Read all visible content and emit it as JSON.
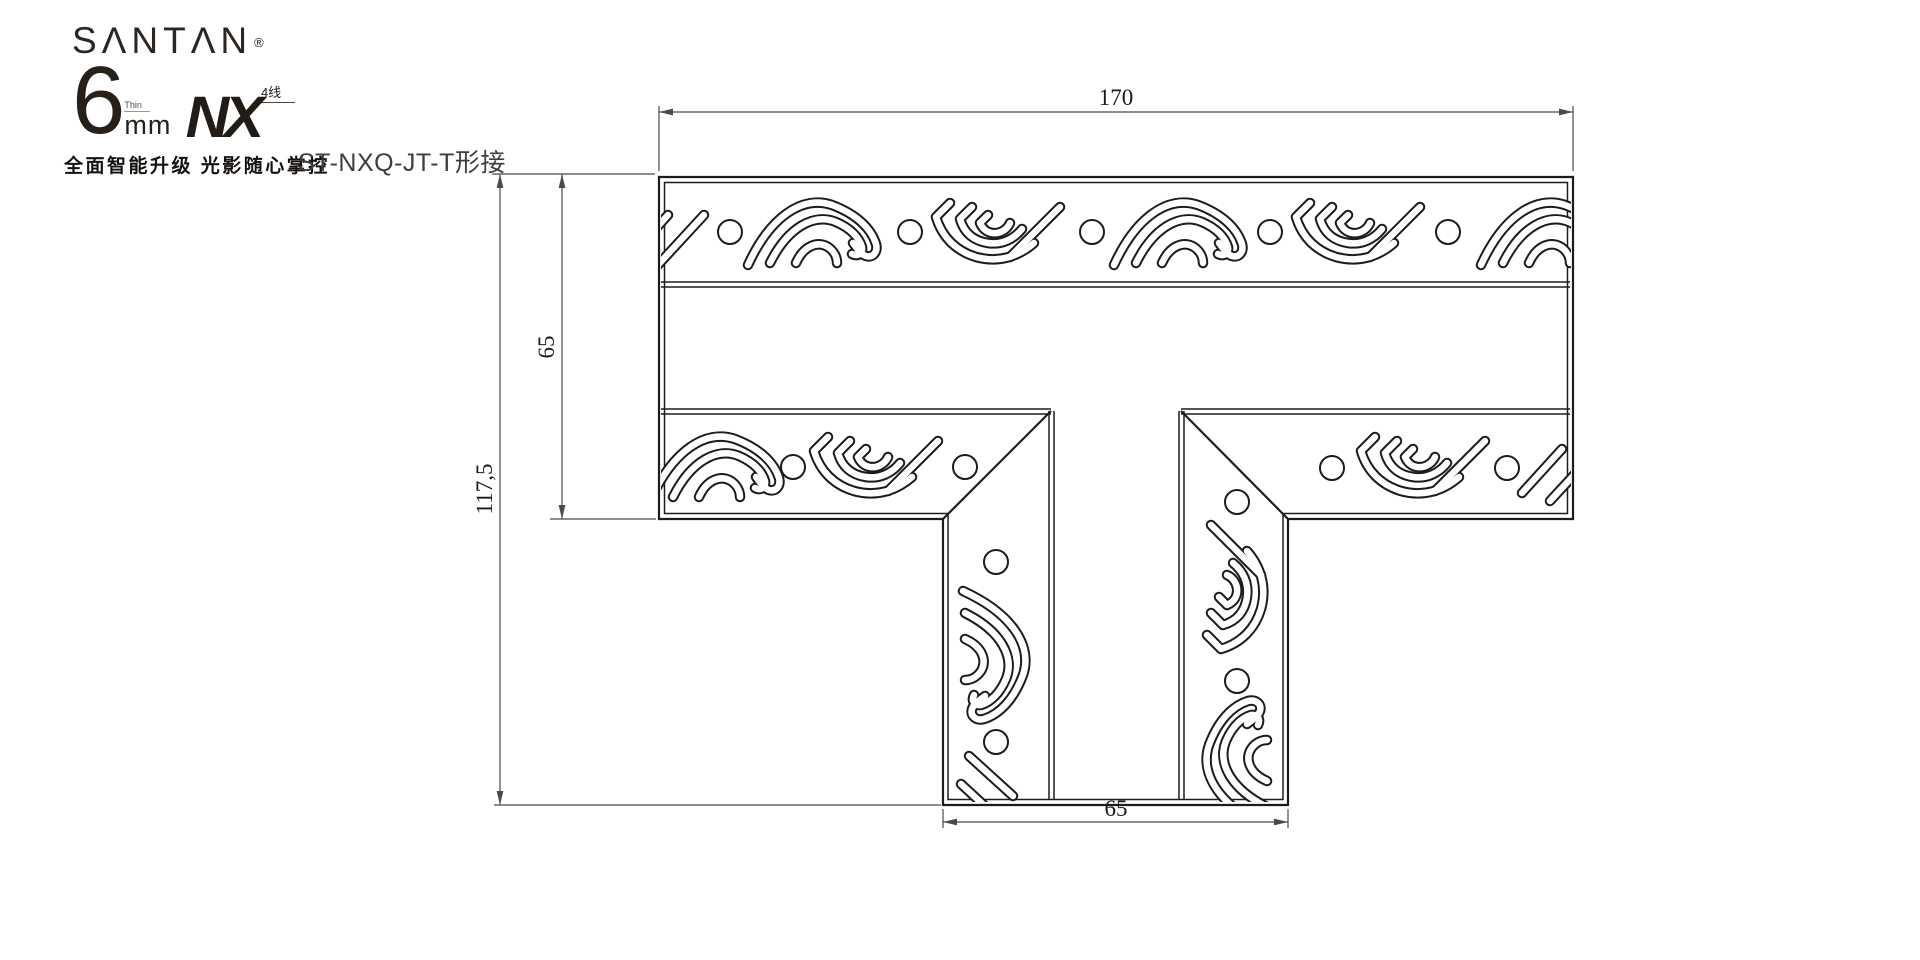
{
  "brand": {
    "name_display": "SΛNTΛN",
    "registered_mark": "®",
    "thickness_number": "6",
    "thickness_note": "Thin",
    "thickness_unit": "mm",
    "series_name": "NX",
    "series_badge": "4线",
    "tagline": "全面智能升级 光影随心掌控"
  },
  "title": {
    "part_number": "ST-NXQ-JT-T形接"
  },
  "drawing": {
    "dimensions": {
      "top_width": "170",
      "arm_depth": "65",
      "total_height": "117,5",
      "stem_width": "65"
    },
    "colors": {
      "outline": "#1c1c1c",
      "dimension_line": "#4a4a4a",
      "label_text": "#1a1a1a",
      "background": "#ffffff"
    }
  }
}
